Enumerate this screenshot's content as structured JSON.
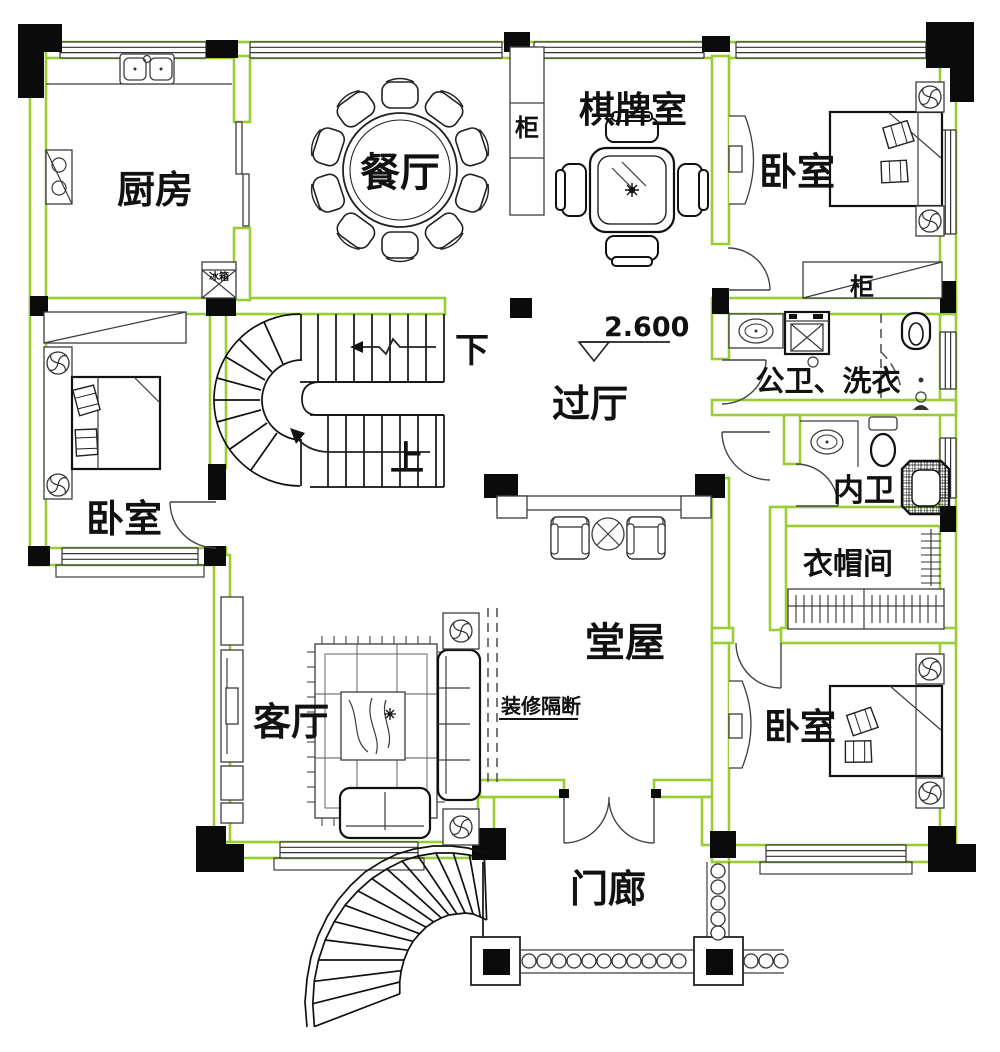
{
  "plan": {
    "colors": {
      "wall_accent": "#9ACD32",
      "line": "#111111",
      "column_fill": "#0B0B0B"
    },
    "rooms": {
      "kitchen": {
        "label": "厨房"
      },
      "dining": {
        "label": "餐厅"
      },
      "chess_room": {
        "label": "棋牌室"
      },
      "bedroom_top_right": {
        "label": "卧室"
      },
      "bedroom_left": {
        "label": "卧室"
      },
      "bedroom_bottom_right": {
        "label": "卧室"
      },
      "hallway": {
        "label": "过厅"
      },
      "bath_laundry": {
        "label": "公卫、洗衣"
      },
      "inner_bath": {
        "label": "内卫"
      },
      "cloakroom": {
        "label": "衣帽间"
      },
      "living_room": {
        "label": "客厅"
      },
      "main_hall": {
        "label": "堂屋"
      },
      "porch": {
        "label": "门廊"
      }
    },
    "annotations": {
      "cabinet_chess": {
        "label": "柜"
      },
      "cabinet_bedroom": {
        "label": "柜"
      },
      "fridge": {
        "label": "冰箱"
      },
      "stairs_down": {
        "label": "下"
      },
      "stairs_up": {
        "label": "上"
      },
      "partition": {
        "label": "装修隔断"
      },
      "elevation": {
        "label": "2.600"
      }
    }
  }
}
